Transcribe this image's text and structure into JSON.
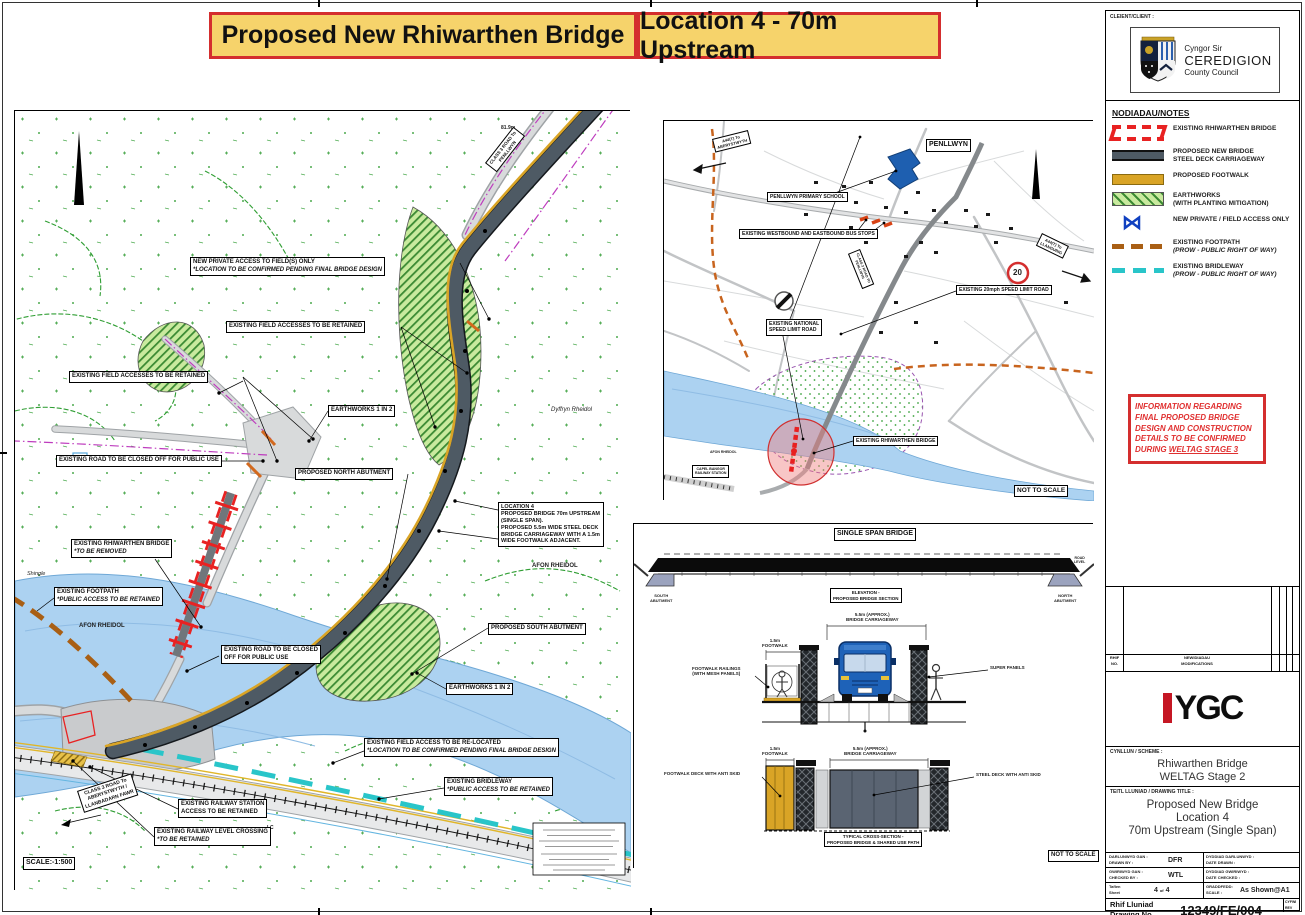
{
  "banner": {
    "left": "Proposed New Rhiwarthen Bridge",
    "right": "Location 4 - 70m Upstream"
  },
  "client": {
    "label": "CLEIENT/CLIENT :",
    "council_line1": "Cyngor Sir",
    "council_line2": "CEREDIGION",
    "council_line3": "County Council"
  },
  "notes": {
    "heading": "NODIADAU/NOTES",
    "legend": [
      {
        "type": "bridge",
        "l1": "EXISTING RHIWARTHEN BRIDGE"
      },
      {
        "type": "deck",
        "l1": "PROPOSED NEW BRIDGE",
        "l2": "STEEL DECK CARRIAGEWAY"
      },
      {
        "type": "footwalk",
        "l1": "PROPOSED FOOTWALK"
      },
      {
        "type": "earthworks",
        "l1": "EARTHWORKS",
        "l2": "(WITH PLANTING MITIGATION)"
      },
      {
        "type": "bowtie",
        "l1": "NEW PRIVATE / FIELD ACCESS ONLY"
      },
      {
        "type": "footpath",
        "l1": "EXISTING FOOTPATH",
        "l2": "(PROW - PUBLIC RIGHT OF WAY)",
        "l2i": true
      },
      {
        "type": "bridleway",
        "l1": "EXISTING BRIDLEWAY",
        "l2": "(PROW - PUBLIC RIGHT OF WAY)",
        "l2i": true
      }
    ]
  },
  "info_box": {
    "l1": "INFORMATION REGARDING",
    "l2": "FINAL PROPOSED BRIDGE",
    "l3": "DESIGN AND CONSTRUCTION",
    "l4": "DETAILS TO BE CONFIRMED",
    "l5a": "DURING ",
    "l5b": "WELTAG STAGE 3"
  },
  "revisions": {
    "ref_l1": "RHIF",
    "ref_l2": "NO.",
    "mods_l1": "NEWIDIADAU",
    "mods_l2": "MODIFICATIONS"
  },
  "ygc": {
    "text": "YGC"
  },
  "scheme": {
    "label": "CYNLLUN / SCHEME :",
    "line1": "Rhiwarthen Bridge",
    "line2": "WELTAG Stage 2"
  },
  "drawing_title": {
    "label": "TEITL LLUNIAD / DRAWING TITLE :",
    "line1": "Proposed New Bridge",
    "line2": "Location 4",
    "line3": "70m Upstream (Single Span)"
  },
  "meta": {
    "drawn_cy": "DARLUNWYD GAN :",
    "drawn_en": "DRAWN BY :",
    "drawn_value": "DFR",
    "date_drawn_cy": "DYDDIAD DARLUNWYD :",
    "date_drawn_en": "DATE DRAWN :",
    "date_drawn_value": "",
    "checked_cy": "GWIRIWYD GAN :",
    "checked_en": "CHECKED BY :",
    "checked_value": "WTL",
    "date_checked_cy": "DYDDIAD GWIRIWYD :",
    "date_checked_en": "DATE CHECKED :",
    "date_checked_value": "",
    "sheet_cy": "Taflen",
    "sheet_en": "Sheet",
    "sheet_value": "4",
    "sheet_of": "of",
    "sheet_total": "4",
    "scale_cy": "GRADDFEDD:",
    "scale_en": "SCALE :",
    "scale_value": "As Shown@A1"
  },
  "drawing_no": {
    "label_cy": "Rhif Lluniad",
    "label_en": "Drawing No.",
    "value": "12349/FE/004",
    "rev_l1": "CYFWI",
    "rev_l2": "REV"
  },
  "colors": {
    "banner_bg": "#F6D36B",
    "banner_border": "#D42E2E",
    "deck": "#4E5A64",
    "footwalk": "#D9A426",
    "earthworks": "#C9EA9E",
    "bridge_red": "#E82222",
    "access_blue": "#1040C0",
    "footpath_brown": "#A95F14",
    "bridleway_cyan": "#29C5C9",
    "river": "#ACD2F1"
  },
  "main_map": {
    "labels": [
      {
        "x": 470,
        "y": 52,
        "rot": -52,
        "fs": 4.5,
        "box": 1,
        "ta": "c",
        "name": "label-class3-road-penllwyn",
        "lines": [
          "CLASS 3 ROAD To",
          "PENLLWYN"
        ]
      },
      {
        "x": 486,
        "y": 14,
        "fs": 5,
        "name": "spot-height",
        "lines": [
          "81.9m"
        ]
      },
      {
        "x": 175,
        "y": 146,
        "fs": 6,
        "box": 1,
        "name": "label-new-private-access",
        "lines": [
          {
            "t": "NEW PRIVATE ACCESS TO FIELD(S) ONLY"
          },
          {
            "t": "*LOCATION TO BE CONFIRMED PENDING FINAL BRIDGE DESIGN",
            "i": 1
          }
        ]
      },
      {
        "x": 211,
        "y": 210,
        "fs": 6,
        "box": 1,
        "name": "label-field-access-retained-1",
        "lines": [
          "EXISTING FIELD ACCESSES TO BE RETAINED"
        ]
      },
      {
        "x": 54,
        "y": 260,
        "fs": 6,
        "box": 1,
        "name": "label-field-access-retained-2",
        "lines": [
          "EXISTING FIELD ACCESSES TO BE RETAINED"
        ]
      },
      {
        "x": 313,
        "y": 294,
        "fs": 6,
        "box": 1,
        "name": "label-earthworks-1",
        "lines": [
          "EARTHWORKS 1 IN 2"
        ]
      },
      {
        "x": 41,
        "y": 344,
        "fs": 6,
        "box": 1,
        "name": "label-road-closed-1",
        "lines": [
          "EXISTING ROAD TO BE CLOSED OFF FOR PUBLIC USE"
        ]
      },
      {
        "x": 280,
        "y": 357,
        "fs": 6,
        "box": 1,
        "name": "label-north-abutment",
        "lines": [
          "PROPOSED NORTH ABUTMENT"
        ]
      },
      {
        "x": 56,
        "y": 428,
        "fs": 6,
        "box": 1,
        "name": "label-existing-bridge",
        "lines": [
          {
            "t": "EXISTING RHIWARTHEN BRIDGE"
          },
          {
            "t": "*TO BE REMOVED",
            "i": 1
          }
        ]
      },
      {
        "x": 39,
        "y": 476,
        "fs": 6,
        "box": 1,
        "name": "label-existing-footpath",
        "lines": [
          {
            "t": "EXISTING FOOTPATH"
          },
          {
            "t": "*PUBLIC ACCESS TO BE RETAINED",
            "i": 1
          }
        ]
      },
      {
        "x": 64,
        "y": 512,
        "fs": 6,
        "name": "river-name",
        "lines": [
          "AFON RHEIDOL"
        ]
      },
      {
        "x": 483,
        "y": 391,
        "w": 100,
        "fs": 5.5,
        "box": 1,
        "wrap": 1,
        "name": "label-location-4",
        "lines": [
          {
            "t": "LOCATION 4",
            "u": 1
          },
          {
            "t": "PROPOSED BRIDGE 70m UPSTREAM (SINGLE SPAN)."
          },
          {
            "t": "PROPOSED 5.5m WIDE STEEL DECK BRIDGE CARRIAGEWAY WITH A 1.5m WIDE FOOTWALK ADJACENT."
          }
        ]
      },
      {
        "x": 517,
        "y": 452,
        "fs": 6,
        "name": "river-name",
        "lines": [
          "AFON RHEIDOL"
        ]
      },
      {
        "x": 473,
        "y": 512,
        "fs": 6,
        "box": 1,
        "name": "label-south-abutment",
        "lines": [
          "PROPOSED SOUTH ABUTMENT"
        ]
      },
      {
        "x": 431,
        "y": 572,
        "fs": 6,
        "box": 1,
        "name": "label-earthworks-2",
        "lines": [
          "EARTHWORKS 1 IN 2"
        ]
      },
      {
        "x": 206,
        "y": 534,
        "fs": 6,
        "box": 1,
        "name": "label-road-closed-2",
        "lines": [
          {
            "t": "EXISTING ROAD TO BE CLOSED"
          },
          {
            "t": "OFF FOR PUBLIC USE"
          }
        ]
      },
      {
        "x": 349,
        "y": 627,
        "fs": 6,
        "box": 1,
        "name": "label-field-access-relocated",
        "lines": [
          {
            "t": "EXISTING FIELD ACCESS TO BE RE-LOCATED"
          },
          {
            "t": "*LOCATION TO BE CONFIRMED PENDING FINAL BRIDGE DESIGN",
            "i": 1
          }
        ]
      },
      {
        "x": 429,
        "y": 666,
        "fs": 6,
        "box": 1,
        "name": "label-existing-bridleway",
        "lines": [
          {
            "t": "EXISTING BRIDLEWAY"
          },
          {
            "t": "*PUBLIC ACCESS TO BE RETAINED",
            "i": 1
          }
        ]
      },
      {
        "x": 62,
        "y": 680,
        "rot": -18,
        "fs": 5,
        "box": 1,
        "ta": "c",
        "name": "label-class3-road-aberystwyth",
        "lines": [
          "CLASS 3 ROAD To",
          "ABERYSTWYTH /",
          "LLANBADARN FAWR"
        ]
      },
      {
        "x": 163,
        "y": 688,
        "fs": 6,
        "box": 1,
        "name": "label-railway-station-access",
        "lines": [
          {
            "t": "EXISTING RAILWAY STATION"
          },
          {
            "t": "ACCESS TO BE RETAINED"
          }
        ]
      },
      {
        "x": 139,
        "y": 716,
        "fs": 6,
        "box": 1,
        "name": "label-level-crossing",
        "lines": [
          {
            "t": "EXISTING RAILWAY LEVEL CROSSING"
          },
          {
            "t": "*TO BE RETAINED",
            "i": 1
          }
        ]
      },
      {
        "x": 8,
        "y": 746,
        "fs": 7,
        "box": 1,
        "name": "scale-label",
        "lines": [
          "SCALE:-1:500"
        ]
      },
      {
        "x": 12,
        "y": 460,
        "fs": 5.5,
        "name": "shingle-text",
        "lines": [
          {
            "t": "Shingle",
            "i": 1,
            "nb": 1
          }
        ]
      },
      {
        "x": 536,
        "y": 296,
        "fs": 6,
        "name": "valley-name",
        "lines": [
          {
            "t": "Dyffryn Rheidol",
            "i": 1,
            "nb": 1
          }
        ]
      },
      {
        "x": 252,
        "y": 714,
        "fs": 5,
        "name": "lc-marker",
        "lines": [
          "LC"
        ]
      }
    ]
  },
  "inset_map": {
    "labels": [
      {
        "x": 262,
        "y": 18,
        "fs": 7,
        "box": 1,
        "name": "label-penllwyn",
        "lines": [
          "PENLLWYN"
        ]
      },
      {
        "x": 48,
        "y": 18,
        "rot": -14,
        "fs": 4,
        "box": 1,
        "ta": "c",
        "name": "label-a44-west",
        "lines": [
          "A44(T) To",
          "ABERYSTWYTH"
        ]
      },
      {
        "x": 378,
        "y": 112,
        "rot": 26,
        "fs": 4,
        "box": 1,
        "ta": "c",
        "name": "label-a44-east",
        "lines": [
          "A44(T) To",
          "LLANGURIG"
        ]
      },
      {
        "x": 103,
        "y": 71,
        "fs": 5,
        "box": 1,
        "name": "label-primary-school",
        "lines": [
          "PENLLWYN PRIMARY SCHOOL"
        ]
      },
      {
        "x": 75,
        "y": 108,
        "fs": 5,
        "box": 1,
        "name": "label-bus-stops",
        "lines": [
          "EXISTING WESTBOUND AND EASTBOUND BUS STOPS"
        ]
      },
      {
        "x": 292,
        "y": 164,
        "fs": 5,
        "box": 1,
        "name": "label-20mph-road",
        "lines": [
          "EXISTING 20mph SPEED LIMIT ROAD"
        ]
      },
      {
        "x": 102,
        "y": 198,
        "fs": 5,
        "box": 1,
        "name": "label-national-speed-road",
        "lines": [
          {
            "t": "EXISTING NATIONAL"
          },
          {
            "t": "SPEED LIMIT ROAD"
          }
        ]
      },
      {
        "x": 189,
        "y": 315,
        "fs": 5,
        "box": 1,
        "name": "label-existing-bridge-inset",
        "lines": [
          "EXISTING RHIWARTHEN BRIDGE"
        ]
      },
      {
        "x": 28,
        "y": 344,
        "fs": 3.5,
        "box": 1,
        "ta": "c",
        "name": "label-capel-bangor-station",
        "lines": [
          {
            "t": "CAPEL BANGOR"
          },
          {
            "t": "RAILWAY STATION"
          }
        ]
      },
      {
        "x": 46,
        "y": 329,
        "fs": 3.5,
        "name": "river-name-inset",
        "lines": [
          "AFON RHEIDOL"
        ]
      },
      {
        "x": 350,
        "y": 364,
        "fs": 6.5,
        "box": 1,
        "name": "not-to-scale-inset",
        "lines": [
          "NOT TO SCALE"
        ]
      },
      {
        "x": 196,
        "y": 128,
        "rot": 68,
        "fs": 3.5,
        "box": 1,
        "ta": "c",
        "name": "label-class3-inset",
        "lines": [
          {
            "t": "CLASS 3 ROAD TO"
          },
          {
            "t": "PENLLWYN"
          }
        ]
      },
      {
        "x": 349,
        "y": 147,
        "fs": 8,
        "name": "speed-limit-20-value",
        "lines": [
          "20"
        ]
      }
    ]
  },
  "bridge_panel": {
    "labels": [
      {
        "x": 200,
        "y": 4,
        "fs": 7,
        "box": 1,
        "name": "panel-title",
        "lines": [
          "SINGLE SPAN BRIDGE"
        ]
      },
      {
        "x": 16,
        "y": 70,
        "fs": 4,
        "ta": "c",
        "name": "south-abutment-caption",
        "lines": [
          {
            "t": "SOUTH"
          },
          {
            "t": "ABUTMENT"
          }
        ]
      },
      {
        "x": 420,
        "y": 70,
        "fs": 4,
        "ta": "c",
        "name": "north-abutment-caption",
        "lines": [
          {
            "t": "NORTH"
          },
          {
            "t": "ABUTMENT"
          }
        ]
      },
      {
        "x": 440,
        "y": 32,
        "fs": 3.5,
        "ta": "c",
        "name": "road-level-caption",
        "lines": [
          {
            "t": "ROAD"
          },
          {
            "t": "LEVEL"
          }
        ]
      },
      {
        "x": 196,
        "y": 64,
        "fs": 4.5,
        "box": 1,
        "ta": "c",
        "name": "elevation-caption",
        "lines": [
          {
            "t": "ELEVATION -"
          },
          {
            "t": "PROPOSED BRIDGE SECTION"
          }
        ]
      },
      {
        "x": 212,
        "y": 88,
        "fs": 4.5,
        "ta": "c",
        "name": "dim-carriageway-1",
        "lines": [
          {
            "t": "5.5m (APPROX.)"
          },
          {
            "t": "BRIDGE CARRIAGEWAY"
          }
        ]
      },
      {
        "x": 128,
        "y": 114,
        "fs": 4.5,
        "ta": "c",
        "name": "dim-footwalk-1",
        "lines": [
          {
            "t": "1.5m"
          },
          {
            "t": "FOOTWALK"
          }
        ]
      },
      {
        "x": 58,
        "y": 142,
        "fs": 4.5,
        "ta": "c",
        "name": "label-footwalk-railings",
        "lines": [
          {
            "t": "FOOTWALK RAILINGS"
          },
          {
            "t": "(WITH MESH PANELS)"
          }
        ]
      },
      {
        "x": 356,
        "y": 141,
        "fs": 4.5,
        "name": "label-super-panels",
        "lines": [
          "SUPER PANELS"
        ]
      },
      {
        "x": 128,
        "y": 222,
        "fs": 4.5,
        "ta": "c",
        "name": "dim-footwalk-2",
        "lines": [
          {
            "t": "1.5m"
          },
          {
            "t": "FOOTWALK"
          }
        ]
      },
      {
        "x": 210,
        "y": 222,
        "fs": 4.5,
        "ta": "c",
        "name": "dim-carriageway-2",
        "lines": [
          {
            "t": "5.5m (APPROX.)"
          },
          {
            "t": "BRIDGE CARRIAGEWAY"
          }
        ]
      },
      {
        "x": 30,
        "y": 247,
        "fs": 4.5,
        "name": "label-footwalk-deck",
        "lines": [
          "FOOTWALK DECK WITH ANTI SKID"
        ]
      },
      {
        "x": 342,
        "y": 248,
        "fs": 4.5,
        "name": "label-steel-deck",
        "lines": [
          "STEEL DECK WITH ANTI SKID"
        ]
      },
      {
        "x": 190,
        "y": 308,
        "fs": 4.5,
        "box": 1,
        "ta": "c",
        "name": "cross-section-caption",
        "lines": [
          {
            "t": "TYPICAL CROSS-SECTION -"
          },
          {
            "t": "PROPOSED BRIDGE & SHARED USE PATH"
          }
        ]
      },
      {
        "x": 414,
        "y": 326,
        "fs": 6,
        "box": 1,
        "name": "not-to-scale-panel",
        "lines": [
          "NOT TO SCALE"
        ]
      }
    ]
  }
}
